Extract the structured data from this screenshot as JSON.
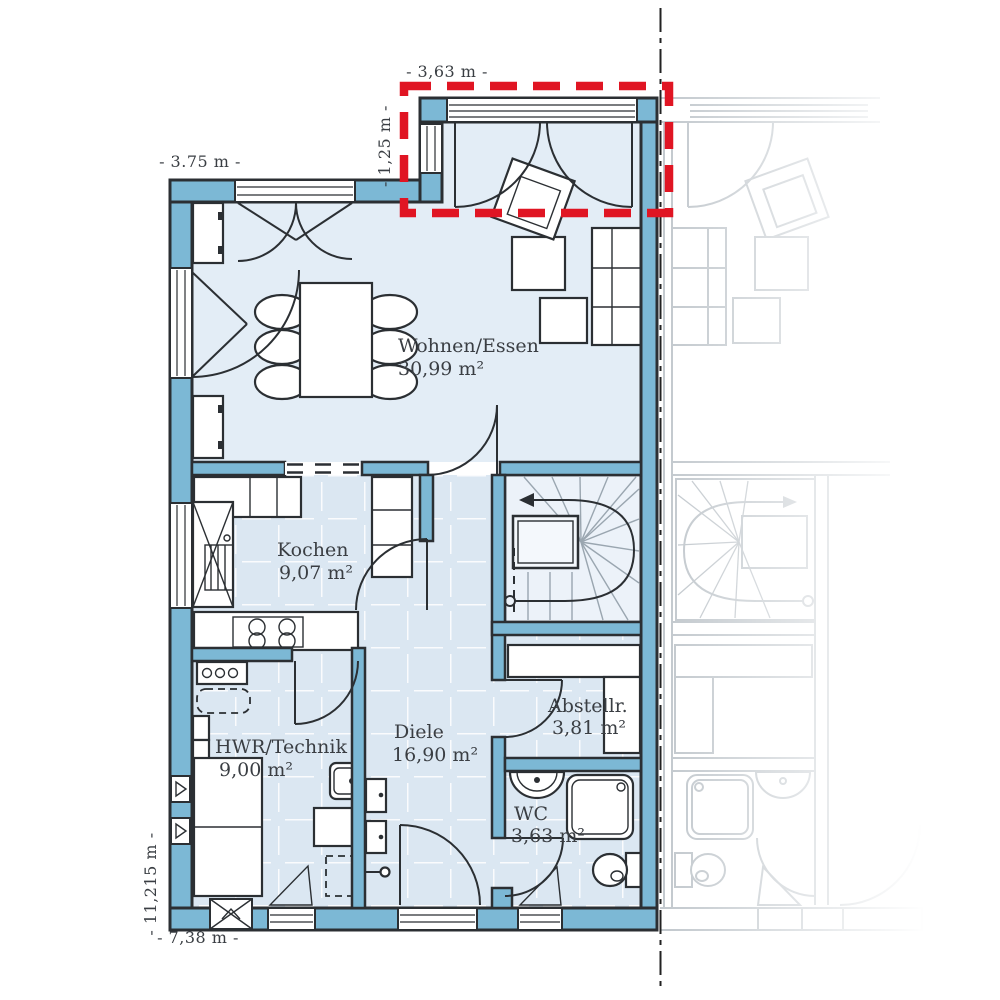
{
  "plan": {
    "rooms": [
      {
        "name": "Wohnen/Essen",
        "area": "30,99 m²"
      },
      {
        "name": "Kochen",
        "area": "9,07 m²"
      },
      {
        "name": "Diele",
        "area": "16,90 m²"
      },
      {
        "name": "HWR/Technik",
        "area": "9,00 m²"
      },
      {
        "name": "Abstellr.",
        "area": "3,81 m²"
      },
      {
        "name": "WC",
        "area": "3,63 m²"
      }
    ],
    "dims": {
      "bay_width": "- 3,63 m -",
      "bay_depth": "- 1,25 m -",
      "front_width": "- 3.75 m -",
      "house_depth": "- 11,215 m -",
      "house_width": "- 7,38 m -"
    },
    "colors": {
      "wall": "#7CB8D5",
      "floor": "#E3EDF6",
      "tile": "#DBE7F2",
      "outline": "#2B2F33",
      "red": "#E01523",
      "neighbor": "#C3C9CE",
      "text": "#3A3E43"
    }
  }
}
